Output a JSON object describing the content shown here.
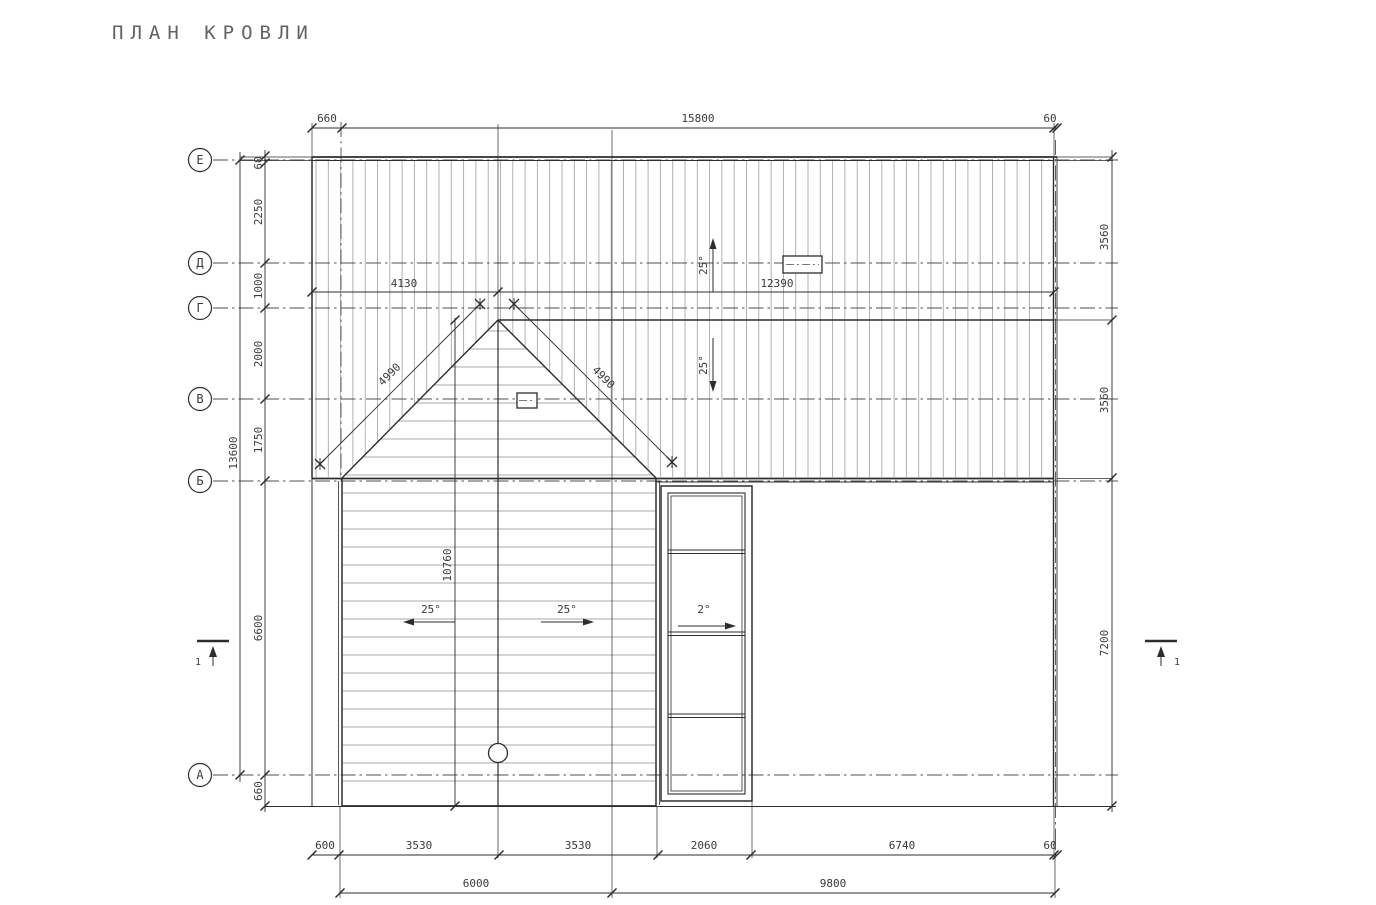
{
  "title": "ПЛАН КРОВЛИ",
  "colors": {
    "background": "#ffffff",
    "line": "#2d2d2d",
    "hatch": "#a9a9a9",
    "axis_line": "#4f4f4f",
    "dim_text": "#3a3a3a",
    "title_text": "#636363"
  },
  "axis_labels": [
    "Е",
    "Д",
    "Г",
    "В",
    "Б",
    "А"
  ],
  "dimensions": {
    "top_row": [
      "660",
      "15800",
      "60"
    ],
    "ridge_row": [
      "4130",
      "12390"
    ],
    "left_inner": [
      "60",
      "2250",
      "1000",
      "2000",
      "1750",
      "6600",
      "660"
    ],
    "left_outer": [
      "13600"
    ],
    "right_col": [
      "3560",
      "3560",
      "7200"
    ],
    "bottom_row1": [
      "600",
      "3530",
      "3530",
      "2060",
      "6740",
      "60"
    ],
    "bottom_row2": [
      "6000",
      "9800"
    ],
    "valley": [
      "4990",
      "4990"
    ],
    "gable_length": [
      "10760"
    ]
  },
  "slope_labels": [
    "25°",
    "25°",
    "25°",
    "25°",
    "2°"
  ],
  "section_marks": [
    "1",
    "1"
  ]
}
